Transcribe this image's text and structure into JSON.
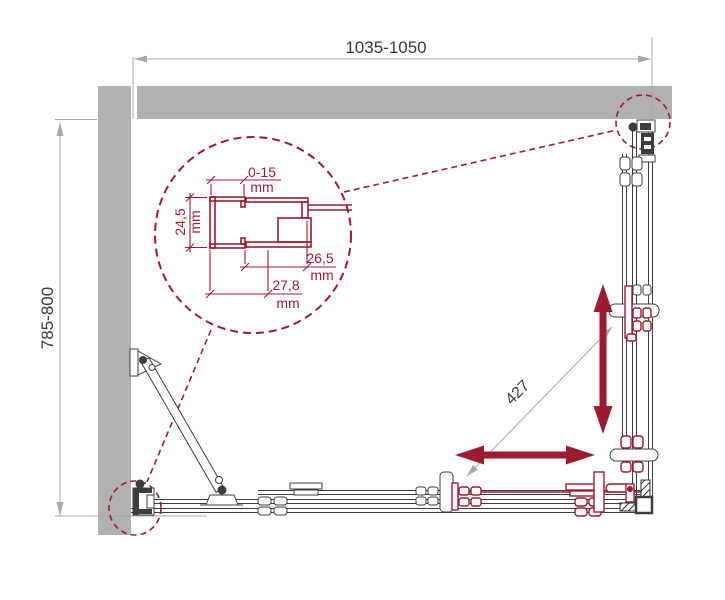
{
  "diagram": {
    "type": "technical-plan-shower-enclosure",
    "dimensions": {
      "width": {
        "value": "1035-1050"
      },
      "depth": {
        "value": "785-800"
      },
      "diagonal": {
        "value": "427"
      }
    },
    "detail": {
      "adjustment_range": "0-15",
      "profile_height": "24,5",
      "inner_depth": "26,5",
      "outer_depth": "27,8",
      "unit": "mm"
    },
    "colors": {
      "accent": "#9c1b31",
      "wall": "#b1b1b1",
      "line": "#3d3d3d",
      "dim": "#a8a8a8",
      "text": "#3a3a3a"
    }
  }
}
